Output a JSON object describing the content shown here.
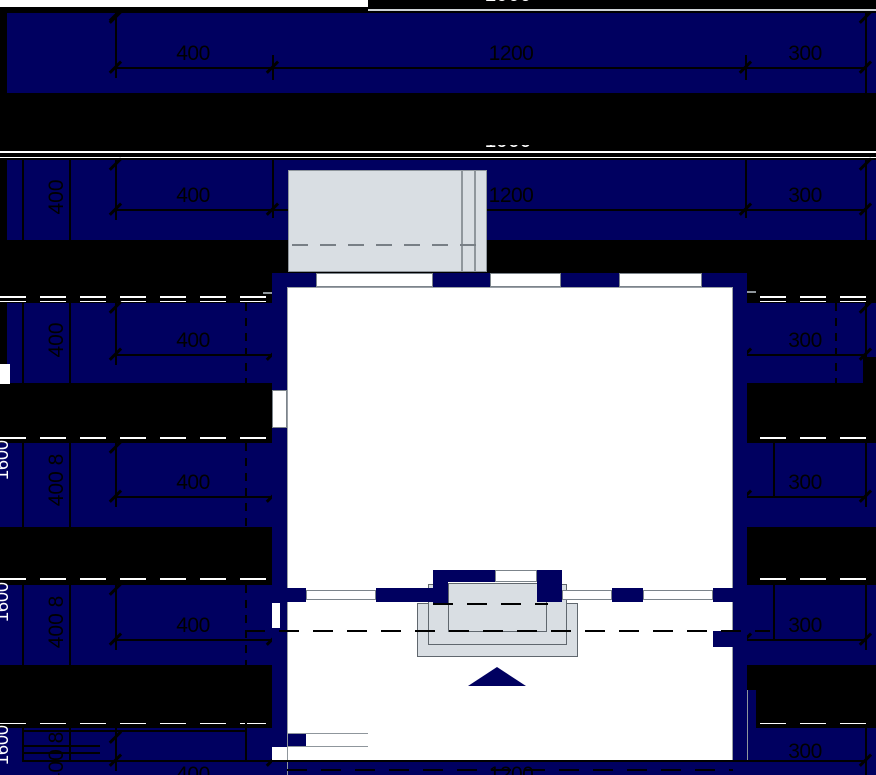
{
  "drawing": {
    "title": "floor-plan-cad-view",
    "horizontal_dimension_chain": {
      "segments": [
        "400",
        "1200",
        "300"
      ],
      "total": "1900"
    },
    "vertical_dimension_chain": {
      "segment": "400",
      "segment_with_next": "400 8",
      "total_clipped": "1600"
    },
    "labels": {
      "h400": "400",
      "h1200": "1200",
      "h300": "300",
      "total": "1900",
      "v400": "400",
      "v400_8": "400 8",
      "vtotal": "1600"
    },
    "colors": {
      "band_navy": "#000060",
      "background_black": "#000000",
      "paper_white": "#ffffff",
      "concrete_gray": "#d9dee3",
      "dim_line_black": "#000000",
      "separator_white": "#ffffff"
    }
  }
}
